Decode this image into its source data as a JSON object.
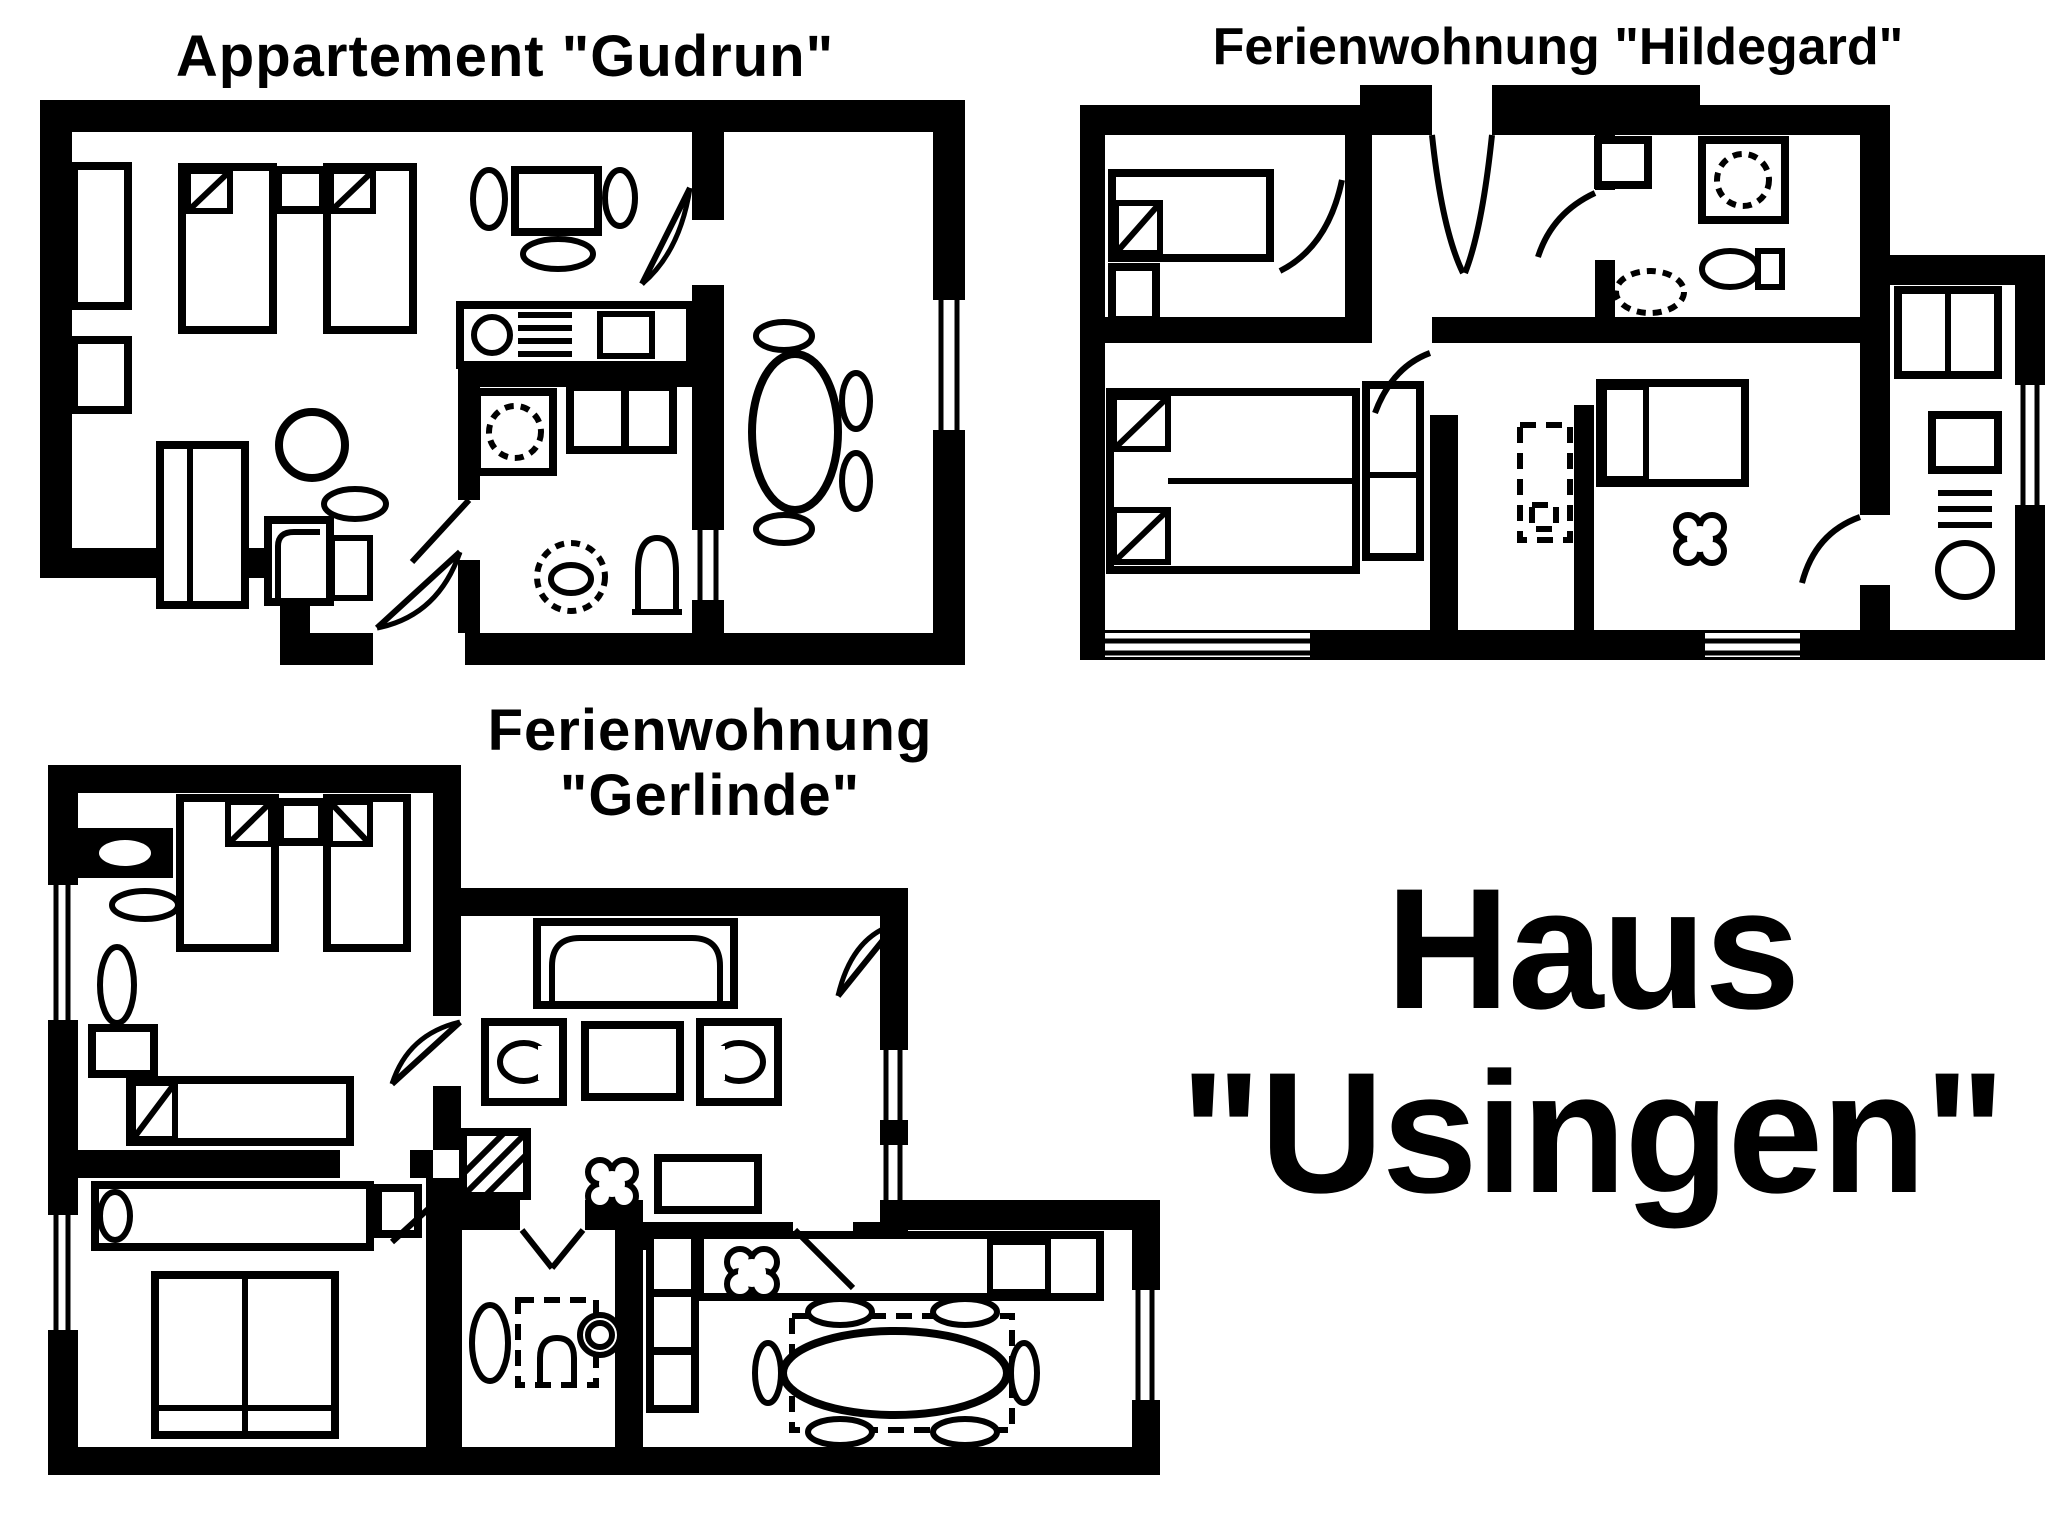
{
  "page": {
    "background": "#ffffff",
    "ink": "#000000",
    "kind": "scanned floor plan sheet"
  },
  "plans": [
    {
      "id": "gudrun",
      "title": "Appartement \"Gudrun\"",
      "furniture_icons": [
        "single-bed-icon",
        "nightstand-icon",
        "radiator-icon",
        "tv-icon",
        "plant-icon",
        "kitchen-counter-icon",
        "stove-icon",
        "sink-icon",
        "round-table-icon",
        "chair-icon",
        "wardrobe-icon",
        "armchair-icon",
        "shower-icon",
        "washbasin-icon",
        "toilet-icon",
        "dining-table-icon",
        "door-swing-icon",
        "window-icon"
      ]
    },
    {
      "id": "hildegard",
      "title": "Ferienwohnung \"Hildegard\"",
      "furniture_icons": [
        "single-bed-icon",
        "double-bed-icon",
        "nightstand-icon",
        "wardrobe-icon",
        "shower-icon",
        "toilet-icon",
        "sink-icon",
        "stool-icon",
        "clover-table-icon",
        "fridge-icon",
        "stove-icon",
        "kitchen-counter-icon",
        "door-swing-icon",
        "window-icon"
      ]
    },
    {
      "id": "gerlinde",
      "title_line1": "Ferienwohnung",
      "title_line2": "\"Gerlinde\"",
      "furniture_icons": [
        "single-bed-icon",
        "double-bed-icon",
        "nightstand-icon",
        "shelf-icon",
        "mirror-icon",
        "dresser-icon",
        "rug-icon",
        "sofa-icon",
        "armchair-icon",
        "coffee-table-icon",
        "tv-cabinet-icon",
        "clover-table-icon",
        "hatch-box-icon",
        "shower-icon",
        "toilet-icon",
        "washbasin-icon",
        "kitchen-counter-icon",
        "stove-icon",
        "sink-icon",
        "dining-table-icon",
        "chair-icon",
        "door-swing-icon",
        "window-icon"
      ]
    }
  ],
  "house_label": {
    "line1": "Haus",
    "line2": "\"Usingen\""
  }
}
